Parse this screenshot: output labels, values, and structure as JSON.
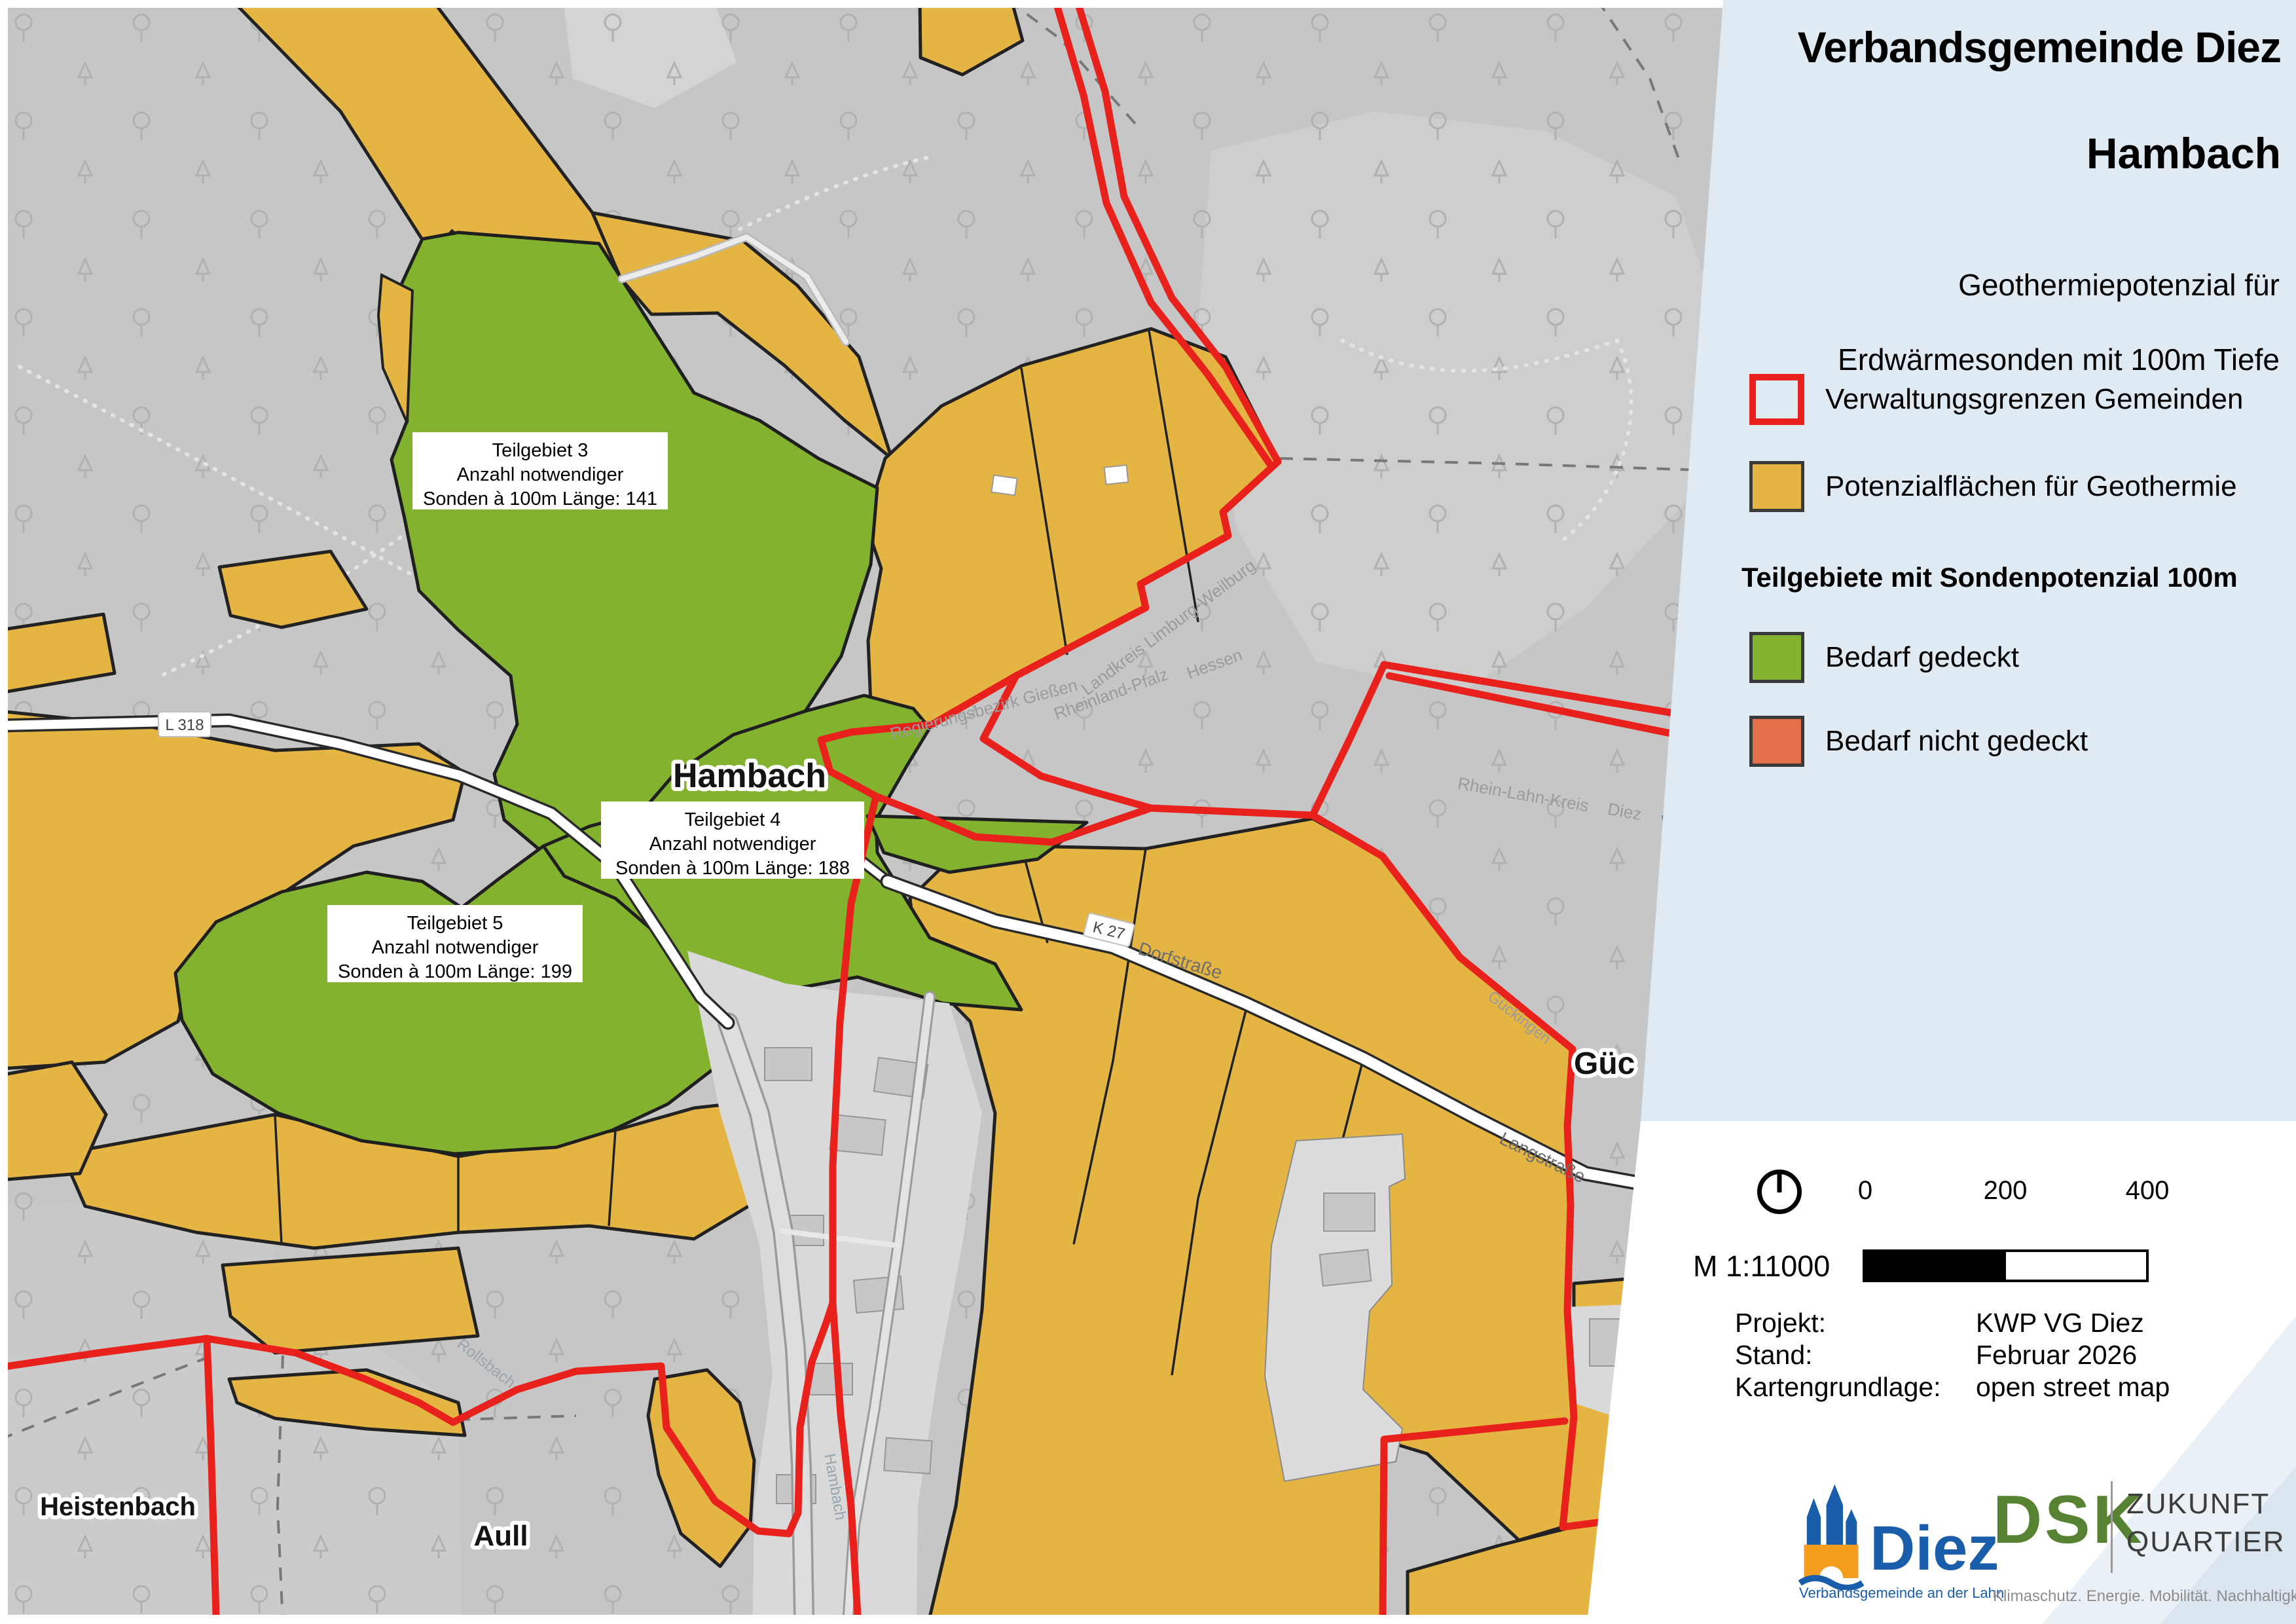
{
  "panel": {
    "title_line1": "Verbandsgemeinde Diez",
    "title_line2": "Hambach",
    "subtitle_line1": "Geothermiepotenzial für",
    "subtitle_line2": "Erdwärmesonden mit 100m Tiefe",
    "legend": {
      "item_admin": "Verwaltungsgrenzen Gemeinden",
      "item_potential": "Potenzialflächen für Geothermie",
      "section_heading": "Teilgebiete mit Sondenpotenzial 100m",
      "item_covered": "Bedarf gedeckt",
      "item_not_covered": "Bedarf nicht gedeckt"
    },
    "scalebar": {
      "ratio": "M 1:11000",
      "tick_0": "0",
      "tick_200": "200",
      "tick_400": "400"
    },
    "project": {
      "label_project": "Projekt:",
      "value_project": "KWP VG Diez",
      "label_date": "Stand:",
      "value_date": "Februar 2026",
      "label_basemap": "Kartengrundlage:",
      "value_basemap": "open street map"
    },
    "logos": {
      "diez_name": "Diez",
      "diez_tagline": "Verbandsgemeinde an der Lahn",
      "dsk_name": "DSK",
      "dsk_line1": "ZUKUNFT",
      "dsk_line2": "QUARTIER",
      "dsk_tagline": "Klimaschutz. Energie. Mobilität. Nachhaltigkeit."
    }
  },
  "map": {
    "area_labels": [
      {
        "line1": "Teilgebiet 3",
        "line2": "Anzahl notwendiger",
        "line3": "Sonden à 100m Länge: 141"
      },
      {
        "line1": "Teilgebiet 4",
        "line2": "Anzahl notwendiger",
        "line3": "Sonden à 100m Länge: 188"
      },
      {
        "line1": "Teilgebiet 5",
        "line2": "Anzahl notwendiger",
        "line3": "Sonden à 100m Länge: 199"
      }
    ],
    "place_labels": {
      "hambach": "Hambach",
      "heistenbach": "Heistenbach",
      "aull": "Aull",
      "gueckingen_partial": "Güc"
    },
    "street_labels": {
      "l318": "L 318",
      "k27": "K 27",
      "dorfstrasse": "Dorfstraße",
      "langstrasse": "Langstraße"
    },
    "boundary_labels": {
      "landkreis": "Landkreis Limburg-Weilburg",
      "hessen": "Hessen",
      "rheinland_pfalz": "Rheinland-Pfalz",
      "rhein_lahn_kreis": "Rhein-Lahn-Kreis",
      "diez": "Diez",
      "regierungsbezirk": "Regierungsbezirk Gießen",
      "gueckingen": "Gückingen"
    },
    "water_labels": {
      "hambach_stream": "Hambach",
      "rollsbach": "Rollsbach"
    },
    "colors": {
      "admin_boundary": "#e8211c",
      "potential_area": "#e5b442",
      "demand_covered": "#84b42f",
      "demand_not_covered": "#e2704a",
      "forest_background": "#c6c6c6",
      "panel_blue": "#e0eaf2"
    }
  }
}
